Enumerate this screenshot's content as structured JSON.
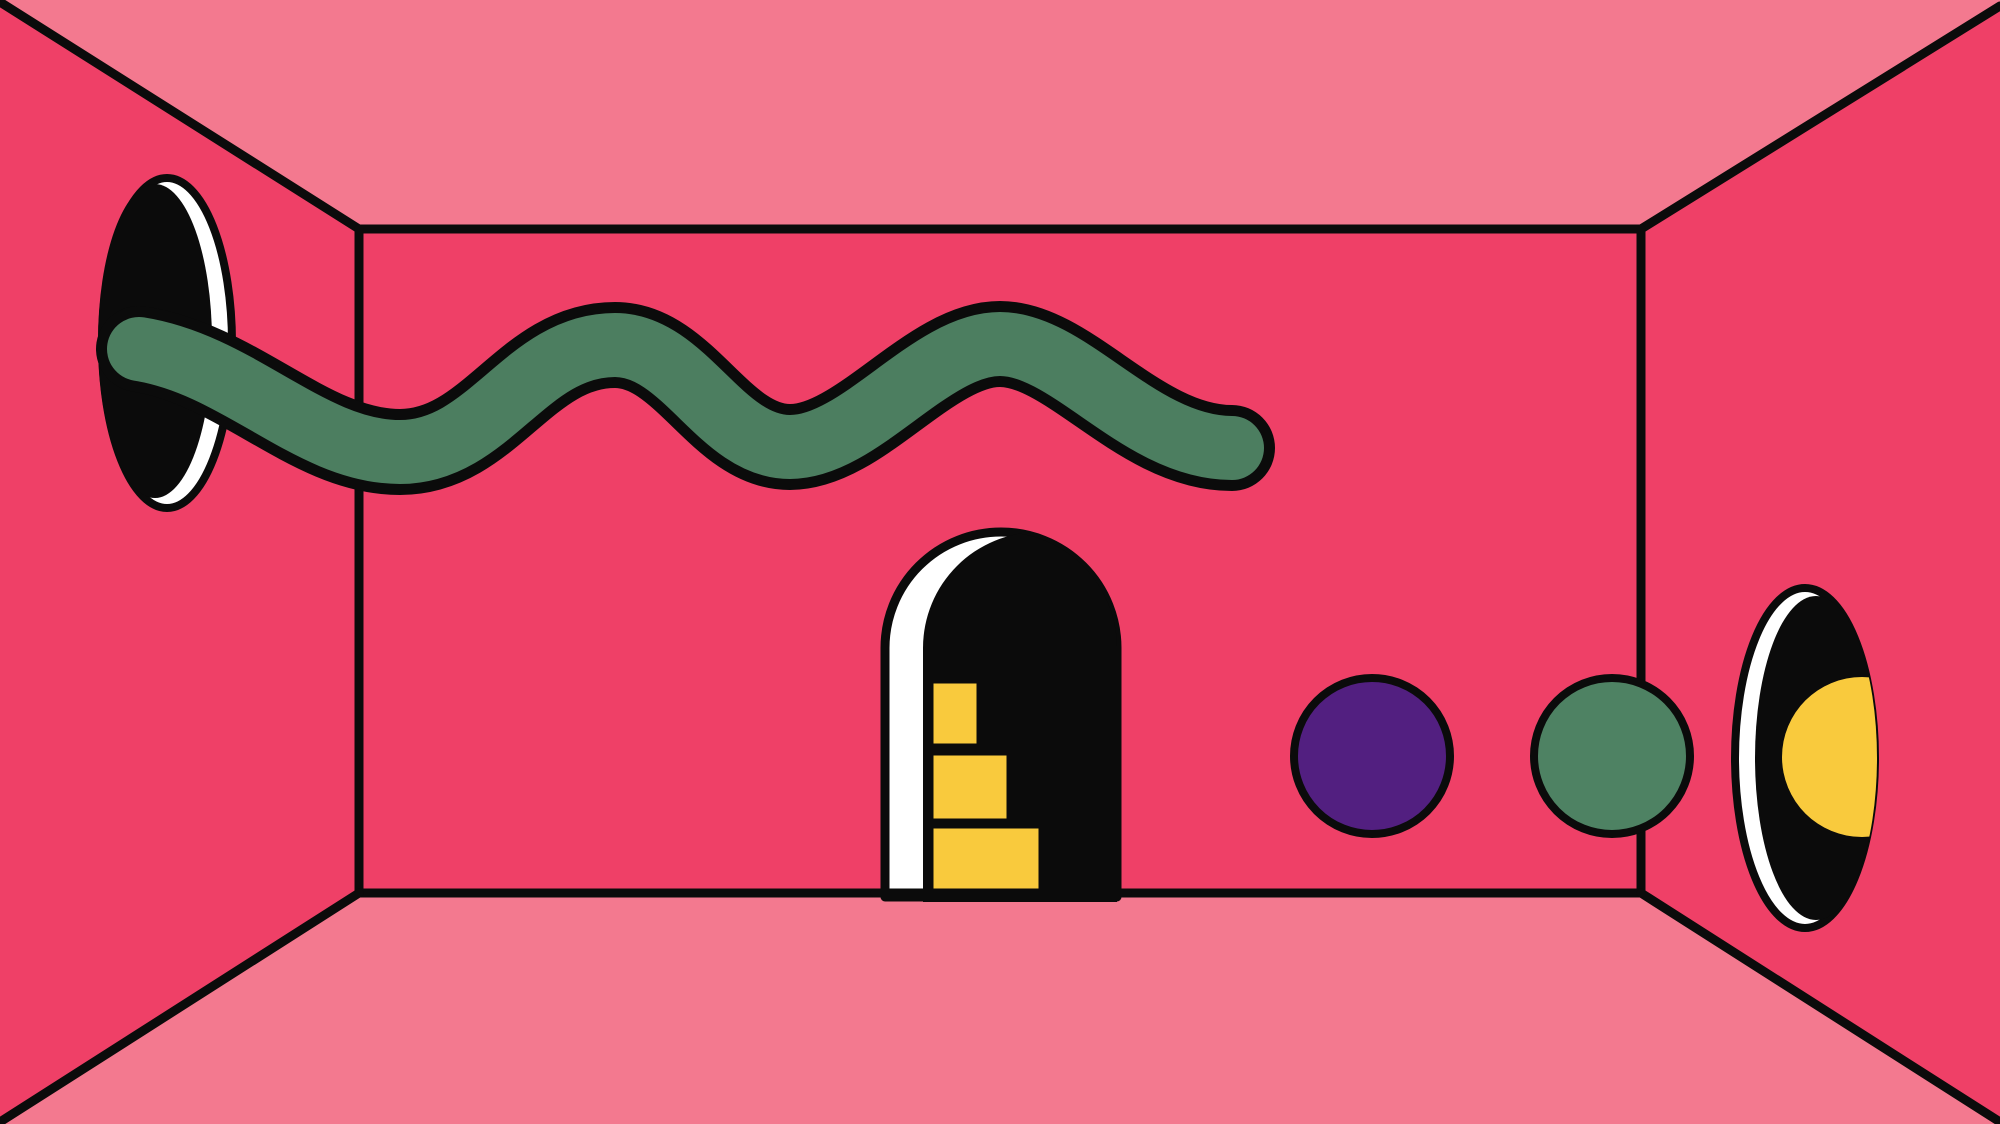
{
  "title": "Abstract room illustration",
  "palette": {
    "wall_dark_pink": "#EF4067",
    "ceiling_floor_pink": "#F3798F",
    "outline_black": "#0B0B0B",
    "snake_green": "#4C7E60",
    "ball_green": "#4E8263",
    "ball_purple": "#521F80",
    "step_yellow": "#F9CA3D",
    "moon_yellow": "#F9CA3D",
    "highlight_white": "#FFFFFF"
  },
  "scene": {
    "elements": [
      "room-in-perspective",
      "left-wall-porthole",
      "green-wavy-snake",
      "arched-doorway-with-steps",
      "purple-ball",
      "green-ball",
      "right-wall-porthole-with-moon"
    ]
  }
}
